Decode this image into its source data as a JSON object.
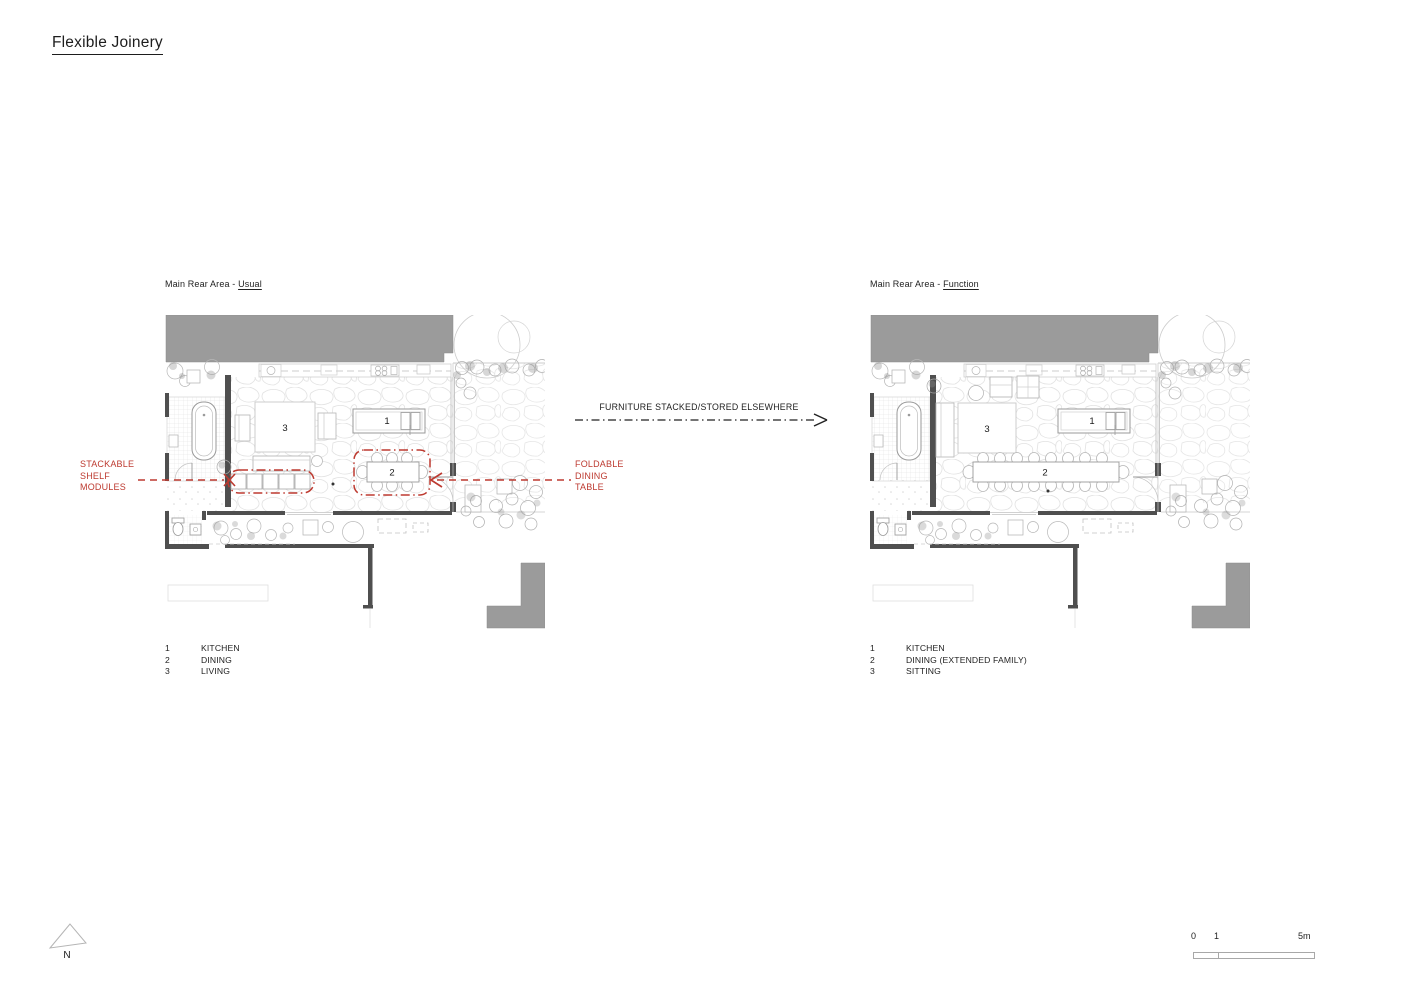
{
  "title": "Flexible Joinery",
  "plans": {
    "left": {
      "label_prefix": "Main Rear Area - ",
      "label_suffix": "Usual",
      "rooms": {
        "kitchen": "1",
        "dining": "2",
        "living": "3"
      },
      "legend": [
        {
          "num": "1",
          "label": "KITCHEN"
        },
        {
          "num": "2",
          "label": "DINING"
        },
        {
          "num": "3",
          "label": "LIVING"
        }
      ]
    },
    "right": {
      "label_prefix": "Main Rear Area - ",
      "label_suffix": "Function",
      "rooms": {
        "kitchen": "1",
        "dining": "2",
        "living": "3"
      },
      "legend": [
        {
          "num": "1",
          "label": "KITCHEN"
        },
        {
          "num": "2",
          "label": "DINING (EXTENDED FAMILY)"
        },
        {
          "num": "3",
          "label": "SITTING"
        }
      ]
    }
  },
  "annotations": {
    "stackable_shelf": {
      "text": "STACKABLE\nSHELF\nMODULES"
    },
    "foldable_table": {
      "text": "FOLDABLE\nDINING\nTABLE"
    },
    "transition": "FURNITURE STACKED/STORED ELSEWHERE"
  },
  "compass": {
    "north_label": "N"
  },
  "scale_bar": {
    "tick_start": "0",
    "tick_one": "1",
    "tick_end": "5m"
  },
  "colors": {
    "annotation_red": "#bd3a30",
    "building_gray": "#9b9b9b",
    "wall_dark": "#4f4f4f",
    "ink": "#1d1d1d"
  }
}
